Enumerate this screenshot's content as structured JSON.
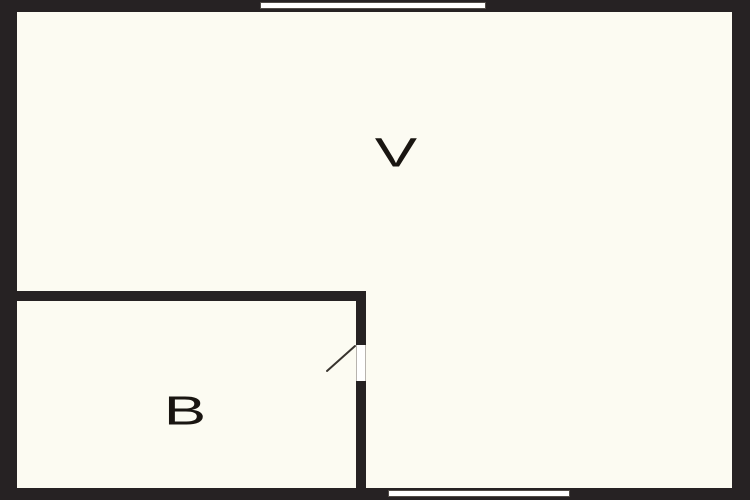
{
  "plan": {
    "type": "floor-plan",
    "rooms": [
      {
        "id": "V",
        "label": "V"
      },
      {
        "id": "B",
        "label": "B"
      }
    ],
    "features": {
      "windows": [
        "top-wall-window",
        "bottom-wall-window"
      ],
      "doors": [
        "room-b-door-with-swing"
      ]
    },
    "colors": {
      "wall": "#262223",
      "floor": "#fcfbf2",
      "window_fill": "#ffffff",
      "label_text": "#191511"
    }
  }
}
